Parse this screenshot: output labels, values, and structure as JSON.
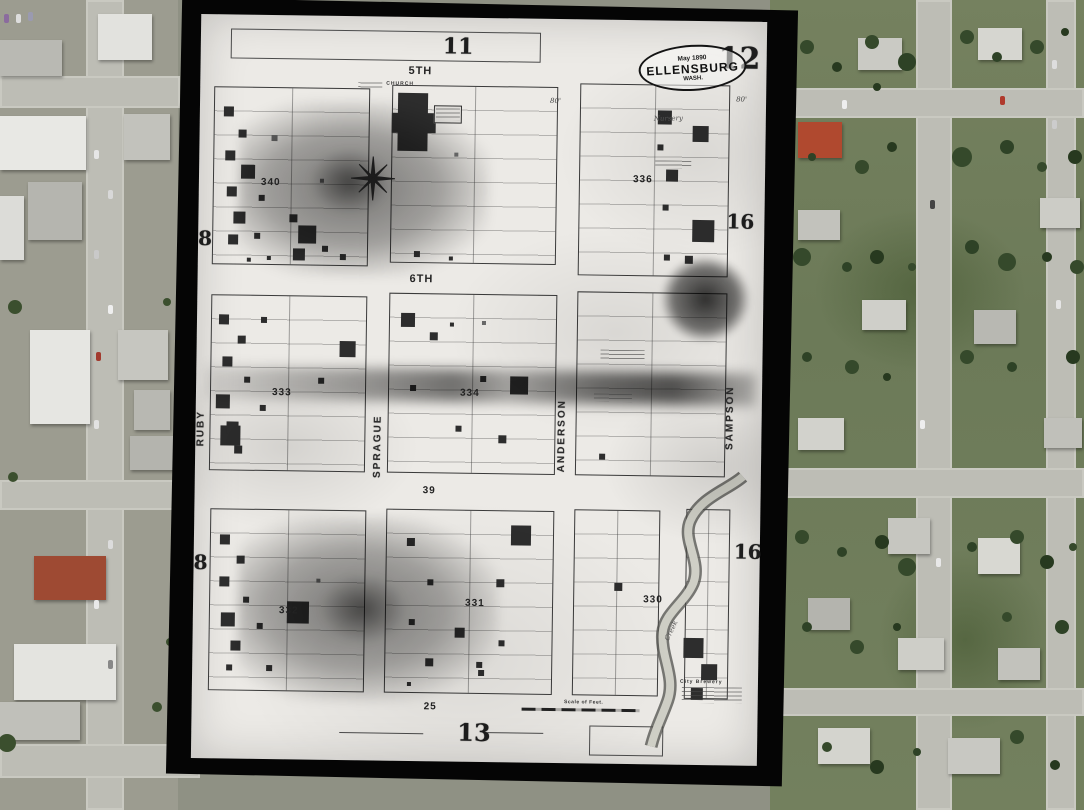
{
  "sanborn": {
    "sheet_number": "12",
    "stamp": {
      "date": "May 1890",
      "city": "ELLENSBURG",
      "state": "WASH."
    },
    "adjacent": {
      "top": "11",
      "bottom": "13",
      "left_upper": "8",
      "left_lower": "8",
      "right_upper": "16",
      "right_lower": "16"
    },
    "streets": {
      "fifth": "5TH",
      "sixth": "6TH",
      "ruby": "RUBY",
      "sprague": "SPRAGUE",
      "anderson": "ANDERSON",
      "sampson": "SAMPSON"
    },
    "blocks": {
      "b340": "340",
      "b336": "336",
      "b333": "333",
      "b334": "334",
      "b339": "39",
      "b332": "332",
      "b331": "331",
      "b330": "330"
    },
    "labels": {
      "church": "CHURCH",
      "nursery": "Nursery",
      "creek": "Creek",
      "brewery": "City Brewery",
      "scale_of_feet": "Scale of Feet.",
      "lot_dim_25": "25",
      "lot_dim_80": "80'"
    }
  }
}
